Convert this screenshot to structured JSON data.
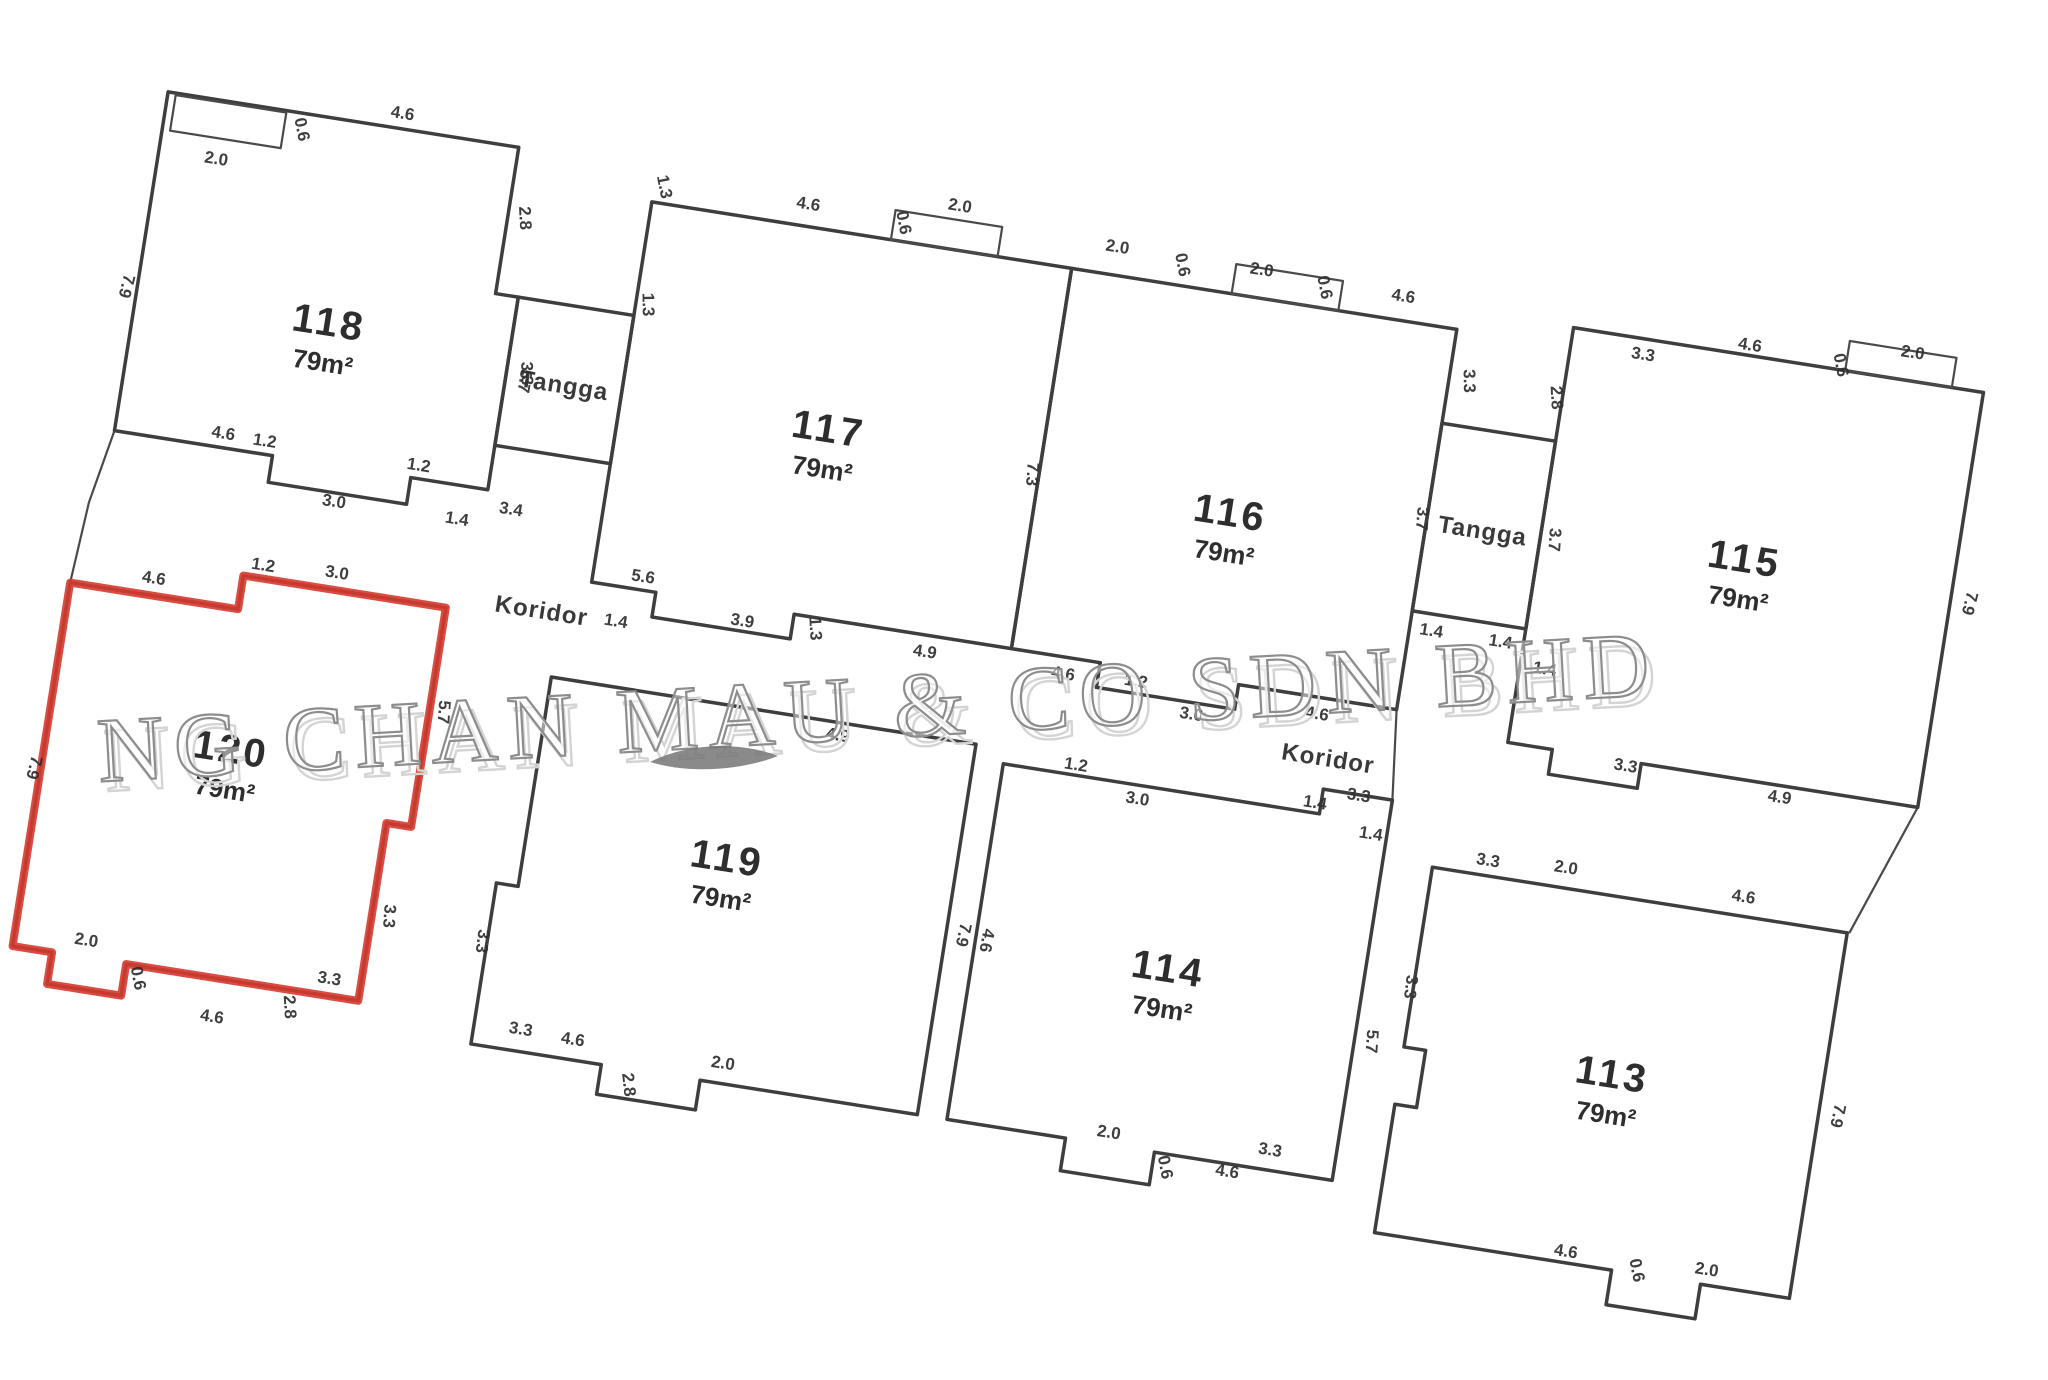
{
  "watermark": {
    "text": "NG CHAN MAU & CO SDN BHD",
    "color": "#8d8d8d",
    "x": 880,
    "y": 738,
    "rot": -3.2,
    "swoosh_path": "M650,762 C690,742 742,742 778,756 C736,772 686,773 650,762 Z"
  },
  "plan": {
    "rotation_deg": 9,
    "origin": {
      "x": 170,
      "y": 80
    },
    "stroke_color": "#3e3e3e",
    "highlight_color": "#d63a2f",
    "units": [
      {
        "id": "118",
        "label": "118",
        "area": "79m²",
        "label_x": 195,
        "label_y": 228,
        "highlighted": false,
        "points": [
          [
            0,
            12
          ],
          [
            355,
            12
          ],
          [
            355,
            160
          ],
          [
            378,
            160
          ],
          [
            378,
            355
          ],
          [
            300,
            355
          ],
          [
            300,
            382
          ],
          [
            160,
            382
          ],
          [
            160,
            355
          ],
          [
            0,
            355
          ]
        ]
      },
      {
        "id": "117",
        "label": "117",
        "area": "79m²",
        "label_x": 705,
        "label_y": 255,
        "highlighted": false,
        "points": [
          [
            495,
            45
          ],
          [
            920,
            45
          ],
          [
            920,
            430
          ],
          [
            700,
            430
          ],
          [
            700,
            455
          ],
          [
            560,
            455
          ],
          [
            560,
            430
          ],
          [
            495,
            430
          ]
        ]
      },
      {
        "id": "116",
        "label": "116",
        "area": "79m²",
        "label_x": 1115,
        "label_y": 275,
        "highlighted": false,
        "points": [
          [
            920,
            45
          ],
          [
            1310,
            45
          ],
          [
            1310,
            430
          ],
          [
            1150,
            430
          ],
          [
            1150,
            455
          ],
          [
            1010,
            455
          ],
          [
            1010,
            430
          ],
          [
            920,
            430
          ]
        ]
      },
      {
        "id": "115",
        "label": "115",
        "area": "79m²",
        "label_x": 1630,
        "label_y": 240,
        "highlighted": false,
        "points": [
          [
            1425,
            25
          ],
          [
            1840,
            25
          ],
          [
            1840,
            445
          ],
          [
            1560,
            445
          ],
          [
            1560,
            470
          ],
          [
            1470,
            470
          ],
          [
            1470,
            445
          ],
          [
            1425,
            445
          ]
        ]
      },
      {
        "id": "119",
        "label": "119",
        "area": "79m²",
        "label_x": 672,
        "label_y": 695,
        "highlighted": false,
        "points": [
          [
            470,
            530
          ],
          [
            900,
            530
          ],
          [
            900,
            905
          ],
          [
            680,
            905
          ],
          [
            680,
            935
          ],
          [
            580,
            935
          ],
          [
            580,
            905
          ],
          [
            448,
            905
          ],
          [
            448,
            742
          ],
          [
            470,
            742
          ]
        ]
      },
      {
        "id": "114",
        "label": "114",
        "area": "79m²",
        "label_x": 1125,
        "label_y": 735,
        "highlighted": false,
        "points": [
          [
            930,
            545
          ],
          [
            1250,
            545
          ],
          [
            1250,
            520
          ],
          [
            1320,
            520
          ],
          [
            1320,
            905
          ],
          [
            1140,
            905
          ],
          [
            1140,
            938
          ],
          [
            1050,
            938
          ],
          [
            1050,
            905
          ],
          [
            930,
            905
          ]
        ]
      },
      {
        "id": "113",
        "label": "113",
        "area": "79m²",
        "label_x": 1580,
        "label_y": 770,
        "highlighted": false,
        "points": [
          [
            1370,
            580
          ],
          [
            1790,
            580
          ],
          [
            1790,
            950
          ],
          [
            1700,
            950
          ],
          [
            1700,
            985
          ],
          [
            1610,
            985
          ],
          [
            1610,
            950
          ],
          [
            1370,
            950
          ],
          [
            1370,
            820
          ],
          [
            1392,
            820
          ],
          [
            1392,
            762
          ],
          [
            1370,
            762
          ]
        ]
      },
      {
        "id": "120",
        "label": "120",
        "area": "79m²",
        "label_x": 165,
        "label_y": 665,
        "highlighted": true,
        "points": [
          [
            -20,
            512
          ],
          [
            150,
            512
          ],
          [
            150,
            478
          ],
          [
            355,
            478
          ],
          [
            355,
            700
          ],
          [
            330,
            700
          ],
          [
            330,
            880
          ],
          [
            95,
            880
          ],
          [
            95,
            912
          ],
          [
            20,
            912
          ],
          [
            20,
            880
          ],
          [
            -20,
            880
          ]
        ]
      }
    ],
    "stair_rooms": [
      {
        "label": "Tangga",
        "x": 378,
        "y": 160,
        "w": 117,
        "h": 150,
        "label_x": 437,
        "label_y": 248
      },
      {
        "label": "Tangga",
        "x": 1310,
        "y": 140,
        "w": 115,
        "h": 190,
        "label_x": 1367,
        "label_y": 248
      }
    ],
    "corridor_labels": [
      {
        "text": "Koridor",
        "x": 450,
        "y": 474
      },
      {
        "text": "Koridor",
        "x": 1250,
        "y": 497
      }
    ],
    "balcony_boxes": [
      [
        8,
        14,
        112,
        36
      ],
      [
        737,
        15,
        108,
        30
      ],
      [
        1082,
        15,
        108,
        30
      ],
      [
        1700,
        -5,
        108,
        30
      ]
    ],
    "connector_lines": [
      [
        [
          0,
          355
        ],
        [
          -14,
          430
        ],
        [
          -20,
          512
        ]
      ],
      [
        [
          1840,
          445
        ],
        [
          1792,
          580
        ]
      ],
      [
        [
          1425,
          330
        ],
        [
          1425,
          445
        ]
      ],
      [
        [
          1310,
          430
        ],
        [
          1320,
          520
        ]
      ],
      [
        [
          495,
          310
        ],
        [
          495,
          430
        ]
      ]
    ],
    "dims": [
      [
        "2.0",
        58,
        76,
        0
      ],
      [
        "0.6",
        133,
        30,
        70
      ],
      [
        "4.6",
        235,
        2,
        0
      ],
      [
        "2.8",
        367,
        82,
        78
      ],
      [
        "7.9",
        -16,
        210,
        95
      ],
      [
        "3.3",
        393,
        235,
        80
      ],
      [
        "4.6",
        108,
        346,
        0
      ],
      [
        "1.2",
        150,
        347,
        0
      ],
      [
        "3.0",
        228,
        396,
        0
      ],
      [
        "1.2",
        306,
        347,
        0
      ],
      [
        "1.4",
        352,
        394,
        0
      ],
      [
        "5.7",
        392,
        242,
        90
      ],
      [
        "3.4",
        404,
        376,
        0
      ],
      [
        "1.3",
        502,
        148,
        80
      ],
      [
        "1.3",
        500,
        30,
        70
      ],
      [
        "4.6",
        650,
        28,
        0
      ],
      [
        "0.6",
        742,
        28,
        70
      ],
      [
        "2.0",
        800,
        6,
        0
      ],
      [
        "7.3",
        908,
        255,
        85
      ],
      [
        "5.6",
        545,
        422,
        0
      ],
      [
        "3.9",
        650,
        450,
        0
      ],
      [
        "1.3",
        718,
        442,
        78
      ],
      [
        "4.9",
        835,
        452,
        0
      ],
      [
        "1.4",
        525,
        470,
        0
      ],
      [
        "2.0",
        962,
        22,
        0
      ],
      [
        "0.6",
        1024,
        26,
        70
      ],
      [
        "2.0",
        1108,
        22,
        0
      ],
      [
        "0.6",
        1168,
        26,
        70
      ],
      [
        "4.6",
        1252,
        26,
        0
      ],
      [
        "3.3",
        1325,
        95,
        80
      ],
      [
        "4.6",
        975,
        452,
        0
      ],
      [
        "1.2",
        1048,
        448,
        0
      ],
      [
        "3.0",
        1108,
        472,
        0
      ],
      [
        "4.6",
        1232,
        452,
        0
      ],
      [
        "3.7",
        1300,
        238,
        85
      ],
      [
        "3.7",
        1434,
        238,
        85
      ],
      [
        "1.4",
        1332,
        352,
        0
      ],
      [
        "1.4",
        1402,
        352,
        0
      ],
      [
        "2.8",
        1414,
        98,
        78
      ],
      [
        "3.3",
        1498,
        46,
        0
      ],
      [
        "4.6",
        1602,
        20,
        0
      ],
      [
        "0.6",
        1690,
        22,
        70
      ],
      [
        "2.0",
        1764,
        2,
        0
      ],
      [
        "7.9",
        1854,
        235,
        95
      ],
      [
        "4.9",
        1702,
        462,
        0
      ],
      [
        "3.3",
        1545,
        455,
        0
      ],
      [
        "1.4",
        1450,
        372,
        0
      ],
      [
        "4.9",
        762,
        548,
        0
      ],
      [
        "7.9",
        912,
        720,
        93
      ],
      [
        "3.3",
        438,
        802,
        88
      ],
      [
        "3.3",
        495,
        888,
        0
      ],
      [
        "4.6",
        548,
        890,
        0
      ],
      [
        "2.8",
        605,
        922,
        75
      ],
      [
        "2.0",
        700,
        890,
        0
      ],
      [
        "1.2",
        1002,
        540,
        0
      ],
      [
        "3.0",
        1068,
        564,
        0
      ],
      [
        "1.4",
        1244,
        540,
        0
      ],
      [
        "1.4",
        1304,
        562,
        0
      ],
      [
        "3.3",
        1286,
        526,
        0
      ],
      [
        "4.6",
        936,
        722,
        92
      ],
      [
        "5.7",
        1332,
        762,
        85
      ],
      [
        "3.3",
        1254,
        890,
        0
      ],
      [
        "2.0",
        1092,
        898,
        0
      ],
      [
        "0.6",
        1148,
        920,
        70
      ],
      [
        "4.6",
        1215,
        918,
        0
      ],
      [
        "3.3",
        1424,
        570,
        0
      ],
      [
        "2.0",
        1502,
        565,
        0
      ],
      [
        "4.6",
        1682,
        566,
        0
      ],
      [
        "7.9",
        1804,
        762,
        93
      ],
      [
        "3.3",
        1362,
        702,
        88
      ],
      [
        "4.6",
        1562,
        944,
        0
      ],
      [
        "0.6",
        1630,
        948,
        70
      ],
      [
        "2.0",
        1704,
        940,
        0
      ],
      [
        "4.6",
        62,
        500,
        0
      ],
      [
        "1.2",
        168,
        470,
        0
      ],
      [
        "3.0",
        242,
        466,
        0
      ],
      [
        "7.9",
        -32,
        700,
        95
      ],
      [
        "5.7",
        364,
        582,
        85
      ],
      [
        "3.3",
        342,
        792,
        85
      ],
      [
        "3.3",
        298,
        868,
        0
      ],
      [
        "2.0",
        52,
        868,
        0
      ],
      [
        "0.6",
        104,
        894,
        70
      ],
      [
        "4.6",
        188,
        924,
        0
      ],
      [
        "2.8",
        258,
        898,
        78
      ]
    ]
  }
}
